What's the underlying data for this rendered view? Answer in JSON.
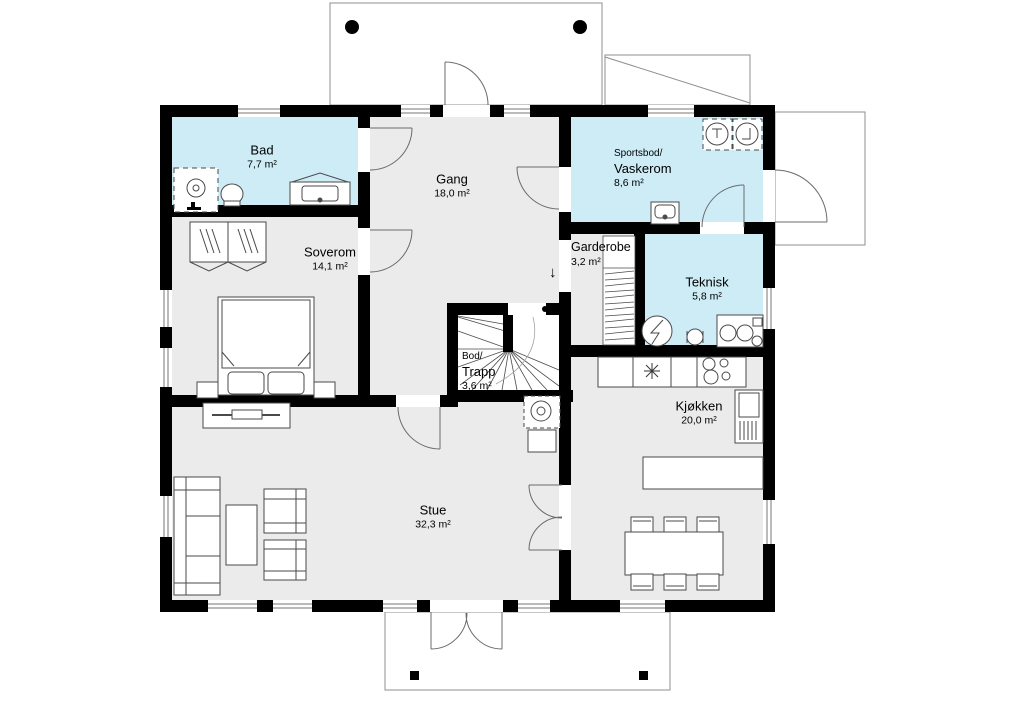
{
  "plan": {
    "title": "Floor plan",
    "rooms": [
      {
        "name": "Bad",
        "area": "7,7 m²"
      },
      {
        "name": "Gang",
        "area": "18,0 m²"
      },
      {
        "prefix": "Sportsbod/",
        "name": "Vaskerom",
        "area": "8,6 m²"
      },
      {
        "name": "Garderobe",
        "area": "3,2 m²"
      },
      {
        "name": "Teknisk",
        "area": "5,8 m²"
      },
      {
        "name": "Soverom",
        "area": "14,1 m²"
      },
      {
        "prefix": "Bod/",
        "name": "Trapp",
        "area": "3,6 m²"
      },
      {
        "name": "Kjøkken",
        "area": "20,0 m²"
      },
      {
        "name": "Stue",
        "area": "32,3 m²"
      }
    ],
    "icons": {
      "stairs_down_arrow": "↓"
    }
  },
  "palette": {
    "wall": "#000000",
    "floor": "#ebebeb",
    "wet_room": "#cdecf6",
    "white": "#ffffff",
    "fixture_line": "#555555",
    "exterior_line": "#8f8f8f"
  }
}
